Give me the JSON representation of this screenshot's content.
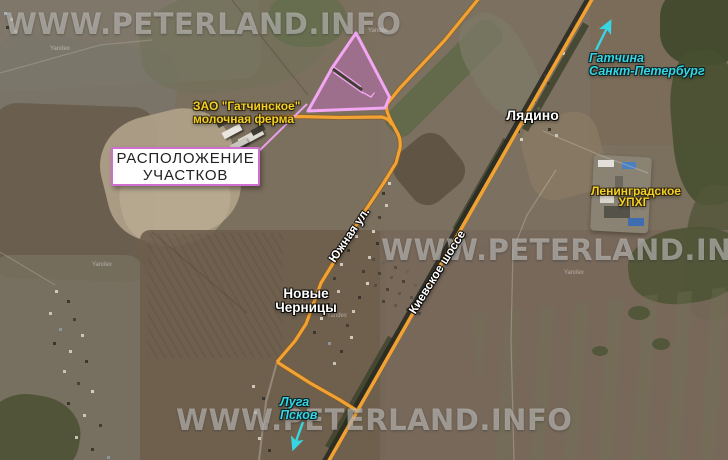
{
  "watermark": {
    "text": "WWW.PETERLAND.INFO"
  },
  "credit": {
    "text": "Yandex"
  },
  "labels": {
    "location_box": {
      "line1": "РАСПОЛОЖЕНИЕ",
      "line2": "УЧАСТКОВ"
    },
    "farm": {
      "line1": "ЗАО \"Гатчинское\"",
      "line2": "молочная ферма"
    },
    "lyadino": "Лядино",
    "gatchina_direction": {
      "line1": "Гатчина",
      "line2": "Санкт-Петербург"
    },
    "upkhg": {
      "line1": "Ленинградское",
      "line2": "УПХГ"
    },
    "novye_chernitsy": {
      "line1": "Новые",
      "line2": "Черницы"
    },
    "luga_direction": {
      "line1": "Луга",
      "line2": "Псков"
    },
    "yuzhnaya_street": "Южная ул.",
    "kievskoe_highway": "Киевское шоссе"
  },
  "colors": {
    "plot_fill": "rgba(200,110,200,0.45)",
    "plot_stroke": "#f3a6f3",
    "road_orange": "#f1a233",
    "label_yellow": "#f2cf2a",
    "label_cyan": "#38d5e2",
    "box_border": "#cf6fcf"
  }
}
